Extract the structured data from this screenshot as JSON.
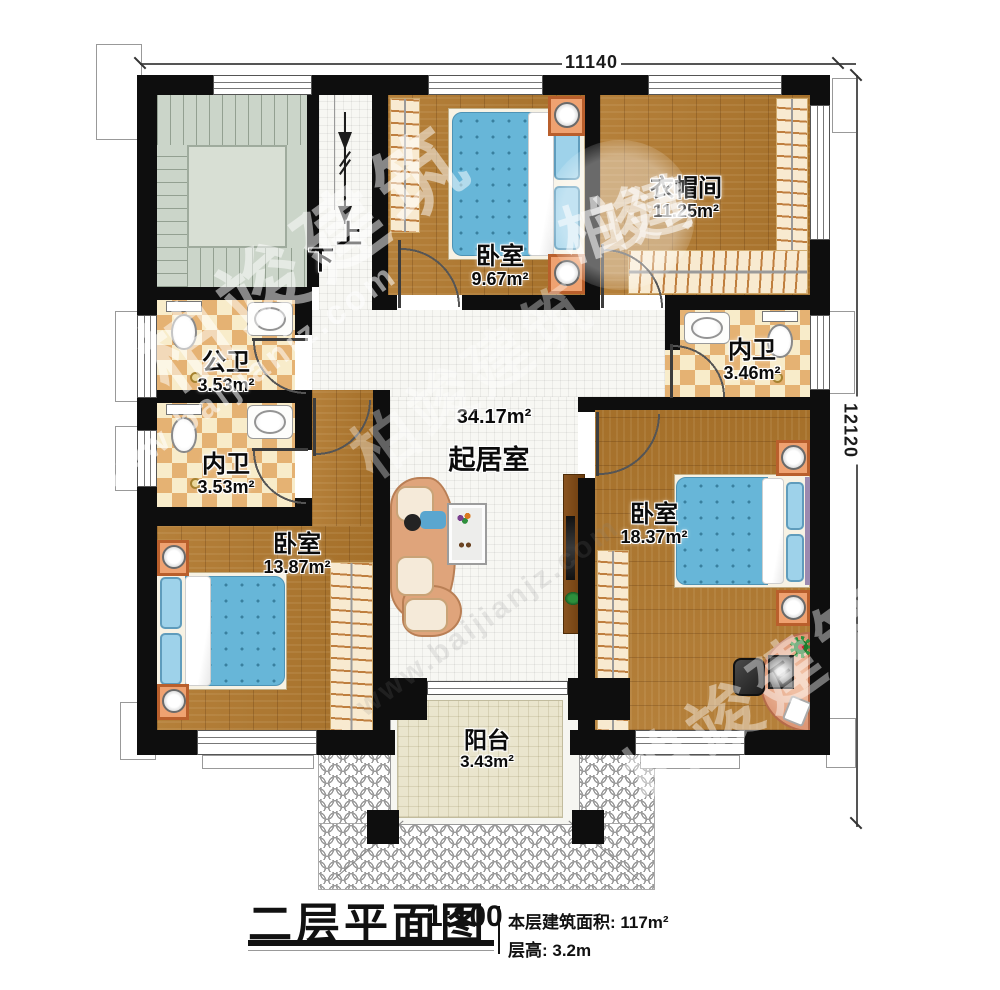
{
  "dimensions": {
    "width_top": "11140",
    "height_right": "12120"
  },
  "stairs": {
    "up": "上",
    "down": "下"
  },
  "rooms": [
    {
      "id": "bedroom-top",
      "name": "卧室",
      "area": "9.67m²"
    },
    {
      "id": "cloakroom",
      "name": "衣帽间",
      "area": "11.25m²"
    },
    {
      "id": "public-bath",
      "name": "公卫",
      "area": "3.53m²"
    },
    {
      "id": "inner-bath-left",
      "name": "内卫",
      "area": "3.53m²"
    },
    {
      "id": "inner-bath-right",
      "name": "内卫",
      "area": "3.46m²"
    },
    {
      "id": "living-room",
      "name": "起居室",
      "area": "34.17m²"
    },
    {
      "id": "bedroom-left",
      "name": "卧室",
      "area": "13.87m²"
    },
    {
      "id": "bedroom-right",
      "name": "卧室",
      "area": "18.37m²"
    },
    {
      "id": "balcony",
      "name": "阳台",
      "area": "3.43m²"
    }
  ],
  "title": {
    "main": "二层平面图",
    "scale": "1:100",
    "building_area": "本层建筑面积: 117m²",
    "floor_height": "层高: 3.2m"
  },
  "watermark": {
    "site": "www.baijianjz.com",
    "brand": "柏竣建筑"
  },
  "colors": {
    "wall": "#0e0e0e",
    "wood": "#ac7832",
    "checker_dark": "#e5b273",
    "checker_light": "#f8ecca",
    "stairs": "#cbd5c9",
    "balcony": "#eae5cd",
    "bed": "#67b6d8"
  }
}
